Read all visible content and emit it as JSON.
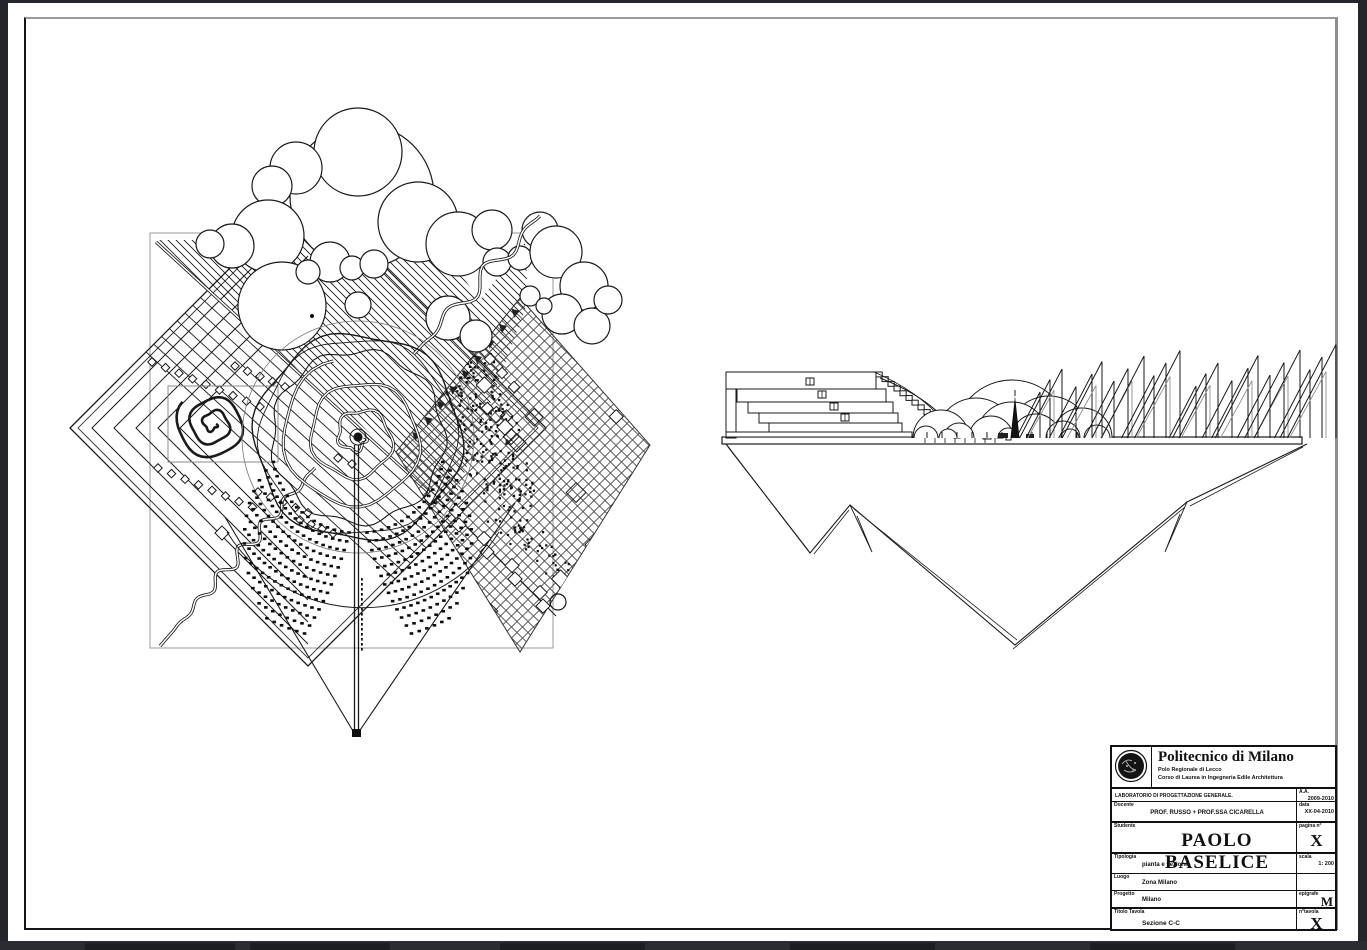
{
  "title_block": {
    "university": "Politecnico di Milano",
    "campus": "Polo Regionale di Lecco",
    "course": "Corso di Laurea in Ingegneria Edile Architettura",
    "lab": "LABORATORIO DI PROGETTAZIONE GENERALE.",
    "docente_label": "Docente",
    "docente": "PROF. RUSSO + PROF.SSA CICARELLA",
    "studente_label": "Studente",
    "studente": "PAOLO BASELICE",
    "aa_label": "A.A.",
    "aa": "2009-2010",
    "data_label": "data",
    "data_value": "XX-04-2010",
    "pagina_label": "pagina n°",
    "pagina": "X",
    "tipologia_label": "Tipologia",
    "tipologia": "pianta e sezione",
    "scala_label": "scala",
    "scala": "1: 200",
    "luogo_label": "Luogo",
    "luogo": "Zona Milano",
    "progetto_label": "Progetto",
    "progetto": "Milano",
    "epigrafe_label": "epigrafe",
    "epigrafe": "M",
    "titolo_label": "Titolo Tavola",
    "titolo": "Sezione C-C",
    "ntavola_label": "n°tavola",
    "ntavola": "X"
  },
  "colors": {
    "ink": "#1a1a1a",
    "paper": "#ffffff",
    "frame_gray": "#9a9a9a",
    "background": "#24262b"
  }
}
